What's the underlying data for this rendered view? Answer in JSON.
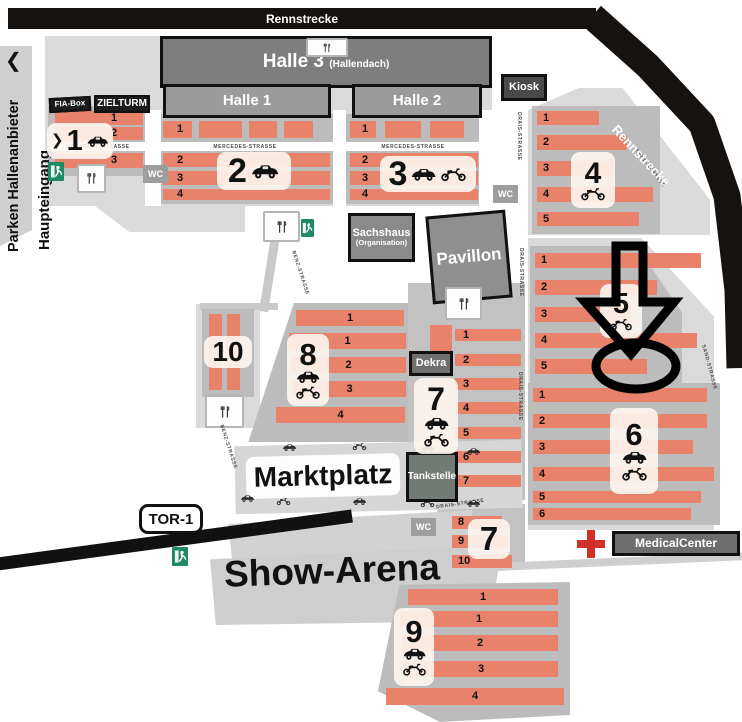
{
  "banners": {
    "rennstrecke": "Rennstrecke"
  },
  "entrance": {
    "chevron_left": "❮",
    "parken": "Parken Hallenanbieter",
    "haupteingang": "Haupteingang",
    "zone1_arrow": "❯",
    "tor1": "TOR-1",
    "ein_ausfahrt": "Ein- / Ausfahrt"
  },
  "buildings": {
    "halle1": "Halle 1",
    "halle2": "Halle 2",
    "halle3": "Halle 3",
    "halle3_sub": "(Hallendach)",
    "kiosk": "Kiosk",
    "fia": "FIA-Box",
    "zielturm": "ZIELTURM",
    "sachshaus": "Sachshaus",
    "sachshaus_sub": "(Organisation)",
    "pavillon": "Pavillon",
    "dekra": "Dekra",
    "tankstelle": "Tankstelle",
    "medical": "MedicalCenter"
  },
  "areas": {
    "marktplatz": "Marktplatz",
    "show_arena": "Show-Arena",
    "wc": "WC"
  },
  "streets": {
    "mercedes": "MERCEDES-STRASSE",
    "drais": "DRAIS-STRASSE",
    "sand": "SAND-STRASSE",
    "benz": "BENZ-STRASSE"
  },
  "zones": {
    "z1": {
      "number": "1",
      "rows": [
        "1",
        "2",
        "3"
      ]
    },
    "z2": {
      "number": "2",
      "rows": [
        "1",
        "2",
        "3",
        "4"
      ]
    },
    "z3": {
      "number": "3",
      "rows": [
        "1",
        "2",
        "3",
        "4"
      ]
    },
    "z4": {
      "number": "4",
      "rows": [
        "1",
        "2",
        "3",
        "4",
        "5"
      ]
    },
    "z5": {
      "number": "5",
      "rows": [
        "1",
        "2",
        "3",
        "4",
        "5"
      ]
    },
    "z6": {
      "number": "6",
      "rows": [
        "1",
        "2",
        "3",
        "4",
        "5",
        "6"
      ]
    },
    "z7": {
      "number": "7",
      "rows": [
        "1",
        "2",
        "3",
        "4",
        "5",
        "6",
        "7"
      ],
      "rows_b": [
        "8",
        "9",
        "10"
      ]
    },
    "z8": {
      "number": "8",
      "rows": [
        "1",
        "1",
        "2",
        "3",
        "4"
      ]
    },
    "z9": {
      "number": "9",
      "rows": [
        "1",
        "1",
        "2",
        "3",
        "4"
      ]
    },
    "z10": {
      "number": "10"
    }
  },
  "colors": {
    "stall_orange": "#e8826a",
    "island_gray": "#dadada",
    "container_gray": "#bcbcbc",
    "track_black": "#15120f",
    "exit_green": "#1e8a63",
    "medical_red": "#d03028"
  },
  "icons": {
    "car": "classic-car-silhouette",
    "moto": "motorcycle-silhouette",
    "food": "fork-knife-snack-stand",
    "exit": "emergency-exit-running-man",
    "cross": "medical-red-cross",
    "marker_arrow": "hand-drawn-arrow-and-circle-marker"
  }
}
